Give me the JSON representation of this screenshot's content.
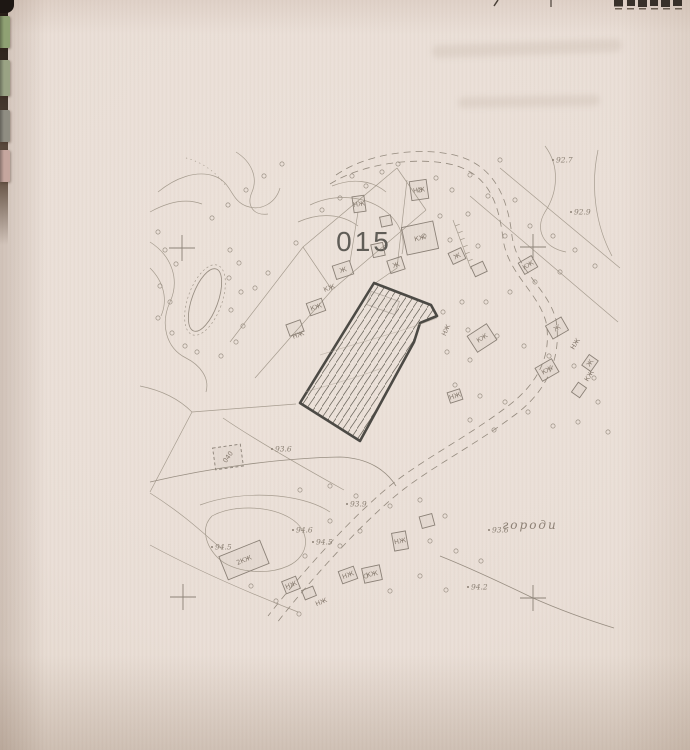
{
  "photo": {
    "binder_tabs": [
      {
        "color": "#8fa173",
        "y": 16,
        "h": 32
      },
      {
        "color": "#9aa384",
        "y": 60,
        "h": 36
      },
      {
        "color": "#8f8d82",
        "y": 110,
        "h": 32
      },
      {
        "color": "#c5a69e",
        "y": 150,
        "h": 32
      }
    ]
  },
  "map": {
    "parcel_number": "015",
    "land_use_label": "городи",
    "small_plot": {
      "x": 228,
      "y": 457,
      "w": 28,
      "h": 22,
      "r": -8,
      "label": "040",
      "label_r": -55
    },
    "elevation_points": [
      {
        "x": 553,
        "y": 160,
        "v": "92.7"
      },
      {
        "x": 571,
        "y": 212,
        "v": "92.9"
      },
      {
        "x": 272,
        "y": 449,
        "v": "93.6"
      },
      {
        "x": 489,
        "y": 530,
        "v": "93.6"
      },
      {
        "x": 347,
        "y": 504,
        "v": "93.9"
      },
      {
        "x": 293,
        "y": 530,
        "v": "94.6"
      },
      {
        "x": 313,
        "y": 542,
        "v": "94.5"
      },
      {
        "x": 212,
        "y": 547,
        "v": "94.5"
      },
      {
        "x": 468,
        "y": 587,
        "v": "94.2"
      }
    ],
    "grid_crosses": [
      [
        182,
        248
      ],
      [
        533,
        247
      ],
      [
        183,
        597
      ],
      [
        533,
        598
      ]
    ],
    "buildings": [
      {
        "x": 420,
        "y": 238,
        "w": 32,
        "h": 28,
        "r": -12,
        "label": "КЖ"
      },
      {
        "x": 419,
        "y": 190,
        "w": 17,
        "h": 19,
        "r": -8,
        "label": "НЖ"
      },
      {
        "x": 359,
        "y": 204,
        "w": 12,
        "h": 16,
        "r": -8,
        "label": "НЖ"
      },
      {
        "x": 386,
        "y": 221,
        "w": 11,
        "h": 10,
        "r": -12,
        "label": ""
      },
      {
        "x": 378,
        "y": 250,
        "w": 12,
        "h": 13,
        "r": -12,
        "label": ""
      },
      {
        "x": 396,
        "y": 265,
        "w": 15,
        "h": 13,
        "r": -18,
        "label": "Ж"
      },
      {
        "x": 343,
        "y": 270,
        "w": 18,
        "h": 14,
        "r": -18,
        "label": "Ж"
      },
      {
        "x": 316,
        "y": 307,
        "w": 16,
        "h": 13,
        "r": -20,
        "label": "КЖ"
      },
      {
        "x": 295,
        "y": 328,
        "w": 15,
        "h": 12,
        "r": -20,
        "label": ""
      },
      {
        "x": 457,
        "y": 256,
        "w": 14,
        "h": 12,
        "r": -25,
        "label": "Ж"
      },
      {
        "x": 479,
        "y": 269,
        "w": 13,
        "h": 11,
        "r": -25,
        "label": ""
      },
      {
        "x": 528,
        "y": 265,
        "w": 15,
        "h": 13,
        "r": -30,
        "label": "КЖ"
      },
      {
        "x": 557,
        "y": 328,
        "w": 18,
        "h": 15,
        "r": -30,
        "label": "Ж"
      },
      {
        "x": 482,
        "y": 338,
        "w": 23,
        "h": 19,
        "r": -33,
        "label": "КЖ"
      },
      {
        "x": 547,
        "y": 370,
        "w": 19,
        "h": 15,
        "r": -30,
        "label": "КЖ"
      },
      {
        "x": 590,
        "y": 363,
        "w": 13,
        "h": 11,
        "r": -55,
        "label": "Ж"
      },
      {
        "x": 579,
        "y": 390,
        "w": 12,
        "h": 10,
        "r": -55,
        "label": ""
      },
      {
        "x": 455,
        "y": 396,
        "w": 13,
        "h": 11,
        "r": -18,
        "label": "НЖ"
      },
      {
        "x": 244,
        "y": 560,
        "w": 44,
        "h": 25,
        "r": -22,
        "label": "2КЖ"
      },
      {
        "x": 291,
        "y": 585,
        "w": 15,
        "h": 13,
        "r": -22,
        "label": "НЖ"
      },
      {
        "x": 309,
        "y": 593,
        "w": 12,
        "h": 10,
        "r": -22,
        "label": ""
      },
      {
        "x": 348,
        "y": 575,
        "w": 16,
        "h": 13,
        "r": -20,
        "label": "НЖ"
      },
      {
        "x": 372,
        "y": 574,
        "w": 18,
        "h": 15,
        "r": -12,
        "label": "КЖ"
      },
      {
        "x": 400,
        "y": 541,
        "w": 14,
        "h": 18,
        "r": -10,
        "label": "НЖ"
      },
      {
        "x": 427,
        "y": 521,
        "w": 13,
        "h": 12,
        "r": -15,
        "label": ""
      }
    ],
    "building_labels": [
      {
        "x": 330,
        "y": 290,
        "t": "КЖ",
        "r": -20
      },
      {
        "x": 299,
        "y": 337,
        "t": "НЖ",
        "r": -20
      },
      {
        "x": 448,
        "y": 331,
        "t": "НЖ",
        "r": -65
      },
      {
        "x": 577,
        "y": 345,
        "t": "НЖ",
        "r": -58
      },
      {
        "x": 591,
        "y": 377,
        "t": "КЖ",
        "r": -58
      },
      {
        "x": 322,
        "y": 604,
        "t": "НЖ",
        "r": -22
      }
    ],
    "trees": [
      [
        420,
        190
      ],
      [
        436,
        178
      ],
      [
        452,
        190
      ],
      [
        470,
        175
      ],
      [
        500,
        160
      ],
      [
        488,
        196
      ],
      [
        515,
        200
      ],
      [
        468,
        214
      ],
      [
        440,
        216
      ],
      [
        424,
        236
      ],
      [
        450,
        240
      ],
      [
        478,
        246
      ],
      [
        505,
        236
      ],
      [
        530,
        226
      ],
      [
        553,
        236
      ],
      [
        575,
        250
      ],
      [
        595,
        266
      ],
      [
        560,
        272
      ],
      [
        535,
        282
      ],
      [
        510,
        292
      ],
      [
        486,
        302
      ],
      [
        462,
        302
      ],
      [
        443,
        312
      ],
      [
        468,
        330
      ],
      [
        497,
        336
      ],
      [
        524,
        346
      ],
      [
        549,
        356
      ],
      [
        574,
        366
      ],
      [
        594,
        378
      ],
      [
        470,
        360
      ],
      [
        447,
        352
      ],
      [
        455,
        385
      ],
      [
        480,
        396
      ],
      [
        505,
        402
      ],
      [
        528,
        412
      ],
      [
        470,
        420
      ],
      [
        494,
        430
      ],
      [
        553,
        426
      ],
      [
        578,
        422
      ],
      [
        598,
        402
      ],
      [
        608,
        432
      ],
      [
        165,
        250
      ],
      [
        176,
        264
      ],
      [
        160,
        286
      ],
      [
        170,
        302
      ],
      [
        158,
        318
      ],
      [
        172,
        333
      ],
      [
        185,
        346
      ],
      [
        230,
        250
      ],
      [
        239,
        263
      ],
      [
        229,
        278
      ],
      [
        241,
        292
      ],
      [
        231,
        310
      ],
      [
        243,
        326
      ],
      [
        236,
        342
      ],
      [
        221,
        356
      ],
      [
        197,
        352
      ],
      [
        300,
        490
      ],
      [
        330,
        486
      ],
      [
        356,
        496
      ],
      [
        390,
        506
      ],
      [
        420,
        500
      ],
      [
        445,
        516
      ],
      [
        330,
        521
      ],
      [
        360,
        531
      ],
      [
        305,
        556
      ],
      [
        340,
        546
      ],
      [
        430,
        541
      ],
      [
        456,
        551
      ],
      [
        420,
        576
      ],
      [
        446,
        590
      ],
      [
        390,
        591
      ],
      [
        366,
        576
      ],
      [
        481,
        561
      ],
      [
        299,
        614
      ],
      [
        276,
        601
      ],
      [
        251,
        586
      ],
      [
        398,
        164
      ],
      [
        382,
        172
      ],
      [
        366,
        186
      ],
      [
        352,
        176
      ],
      [
        340,
        198
      ],
      [
        322,
        210
      ],
      [
        296,
        243
      ],
      [
        268,
        273
      ],
      [
        255,
        288
      ],
      [
        158,
        232
      ],
      [
        212,
        218
      ],
      [
        228,
        205
      ],
      [
        246,
        190
      ],
      [
        264,
        176
      ],
      [
        282,
        164
      ]
    ]
  }
}
